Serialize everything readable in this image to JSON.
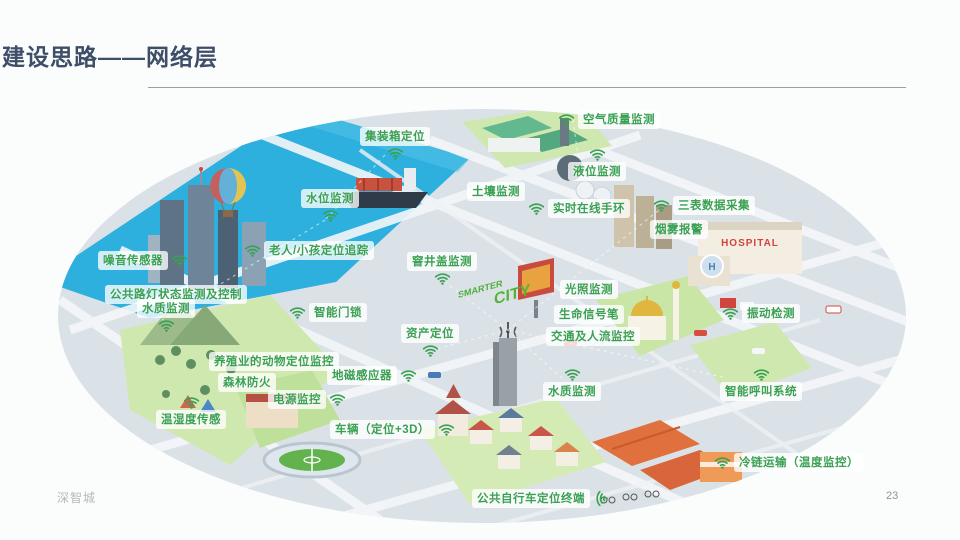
{
  "slide": {
    "title": "建设思路——网络层",
    "page_number": "23",
    "watermark": "深智城"
  },
  "colors": {
    "title": "#3e4d68",
    "label_green": "#3aa053",
    "water": "#2db0de",
    "island": "#dbe2e7"
  },
  "map": {
    "landmarks": {
      "hospital_sign": "HOSPITAL",
      "helipad": "H",
      "city_sign_line1": "SMARTER",
      "city_sign_line2": "CITY"
    },
    "labels": [
      {
        "name": "container-positioning",
        "text": "集装箱定位",
        "x": 360,
        "y": 127,
        "icon": "below"
      },
      {
        "name": "air-quality-monitoring",
        "text": "空气质量监测",
        "x": 558,
        "y": 110,
        "icon": "left"
      },
      {
        "name": "liquid-level-monitoring",
        "text": "液位监测",
        "x": 568,
        "y": 148,
        "icon": "above"
      },
      {
        "name": "water-level-monitoring",
        "text": "水位监测",
        "x": 301,
        "y": 189,
        "icon": "below"
      },
      {
        "name": "soil-monitoring",
        "text": "土壤监测",
        "x": 467,
        "y": 182,
        "icon": "none"
      },
      {
        "name": "realtime-wristband",
        "text": "实时在线手环",
        "x": 528,
        "y": 199,
        "icon": "left"
      },
      {
        "name": "meter-data-collection",
        "text": "三表数据采集",
        "x": 653,
        "y": 196,
        "icon": "left"
      },
      {
        "name": "smoke-alarm",
        "text": "烟雾报警",
        "x": 650,
        "y": 220,
        "icon": "none"
      },
      {
        "name": "noise-sensor",
        "text": "噪音传感器",
        "x": 98,
        "y": 251,
        "icon": "right"
      },
      {
        "name": "elder-child-tracking",
        "text": "老人/小孩定位追踪",
        "x": 244,
        "y": 241,
        "icon": "left"
      },
      {
        "name": "street-light-monitoring",
        "text": "公共路灯状态监测及控制",
        "x": 105,
        "y": 285,
        "icon": "none"
      },
      {
        "name": "water-quality-monitoring-left",
        "text": "水质监测",
        "x": 137,
        "y": 299,
        "icon": "below"
      },
      {
        "name": "smart-door-lock",
        "text": "智能门锁",
        "x": 289,
        "y": 303,
        "icon": "left"
      },
      {
        "name": "manhole-cover-monitoring",
        "text": "窨井盖监测",
        "x": 407,
        "y": 252,
        "icon": "below"
      },
      {
        "name": "asset-positioning",
        "text": "资产定位",
        "x": 401,
        "y": 324,
        "icon": "below"
      },
      {
        "name": "light-monitoring",
        "text": "光照监测",
        "x": 560,
        "y": 280,
        "icon": "none"
      },
      {
        "name": "life-signal-pen",
        "text": "生命信号笔",
        "x": 554,
        "y": 305,
        "icon": "none"
      },
      {
        "name": "traffic-people-flow",
        "text": "交通及人流监控",
        "x": 546,
        "y": 327,
        "icon": "none"
      },
      {
        "name": "vibration-detection",
        "text": "振动检测",
        "x": 722,
        "y": 304,
        "icon": "left"
      },
      {
        "name": "livestock-tracking",
        "text": "养殖业的动物定位监控",
        "x": 209,
        "y": 352,
        "icon": "none"
      },
      {
        "name": "forest-fire-prevention",
        "text": "森林防火",
        "x": 218,
        "y": 373,
        "icon": "none"
      },
      {
        "name": "geomagnetic-sensor",
        "text": "地磁感应器",
        "x": 327,
        "y": 366,
        "icon": "right"
      },
      {
        "name": "power-monitoring",
        "text": "电源监控",
        "x": 268,
        "y": 390,
        "icon": "right"
      },
      {
        "name": "temp-humidity-sensing",
        "text": "温湿度传感",
        "x": 156,
        "y": 396,
        "icon": "above"
      },
      {
        "name": "vehicle-positioning",
        "text": "车辆（定位+3D）",
        "x": 330,
        "y": 420,
        "icon": "right"
      },
      {
        "name": "water-quality-monitoring-bottom",
        "text": "水质监测",
        "x": 543,
        "y": 368,
        "icon": "above"
      },
      {
        "name": "smart-call-system",
        "text": "智能呼叫系统",
        "x": 720,
        "y": 368,
        "icon": "above"
      },
      {
        "name": "cold-chain-transport",
        "text": "冷链运输（温度监控）",
        "x": 714,
        "y": 453,
        "icon": "left"
      },
      {
        "name": "public-bike-terminal",
        "text": "公共自行车定位终端",
        "x": 472,
        "y": 489,
        "icon": "signal-right"
      }
    ]
  }
}
